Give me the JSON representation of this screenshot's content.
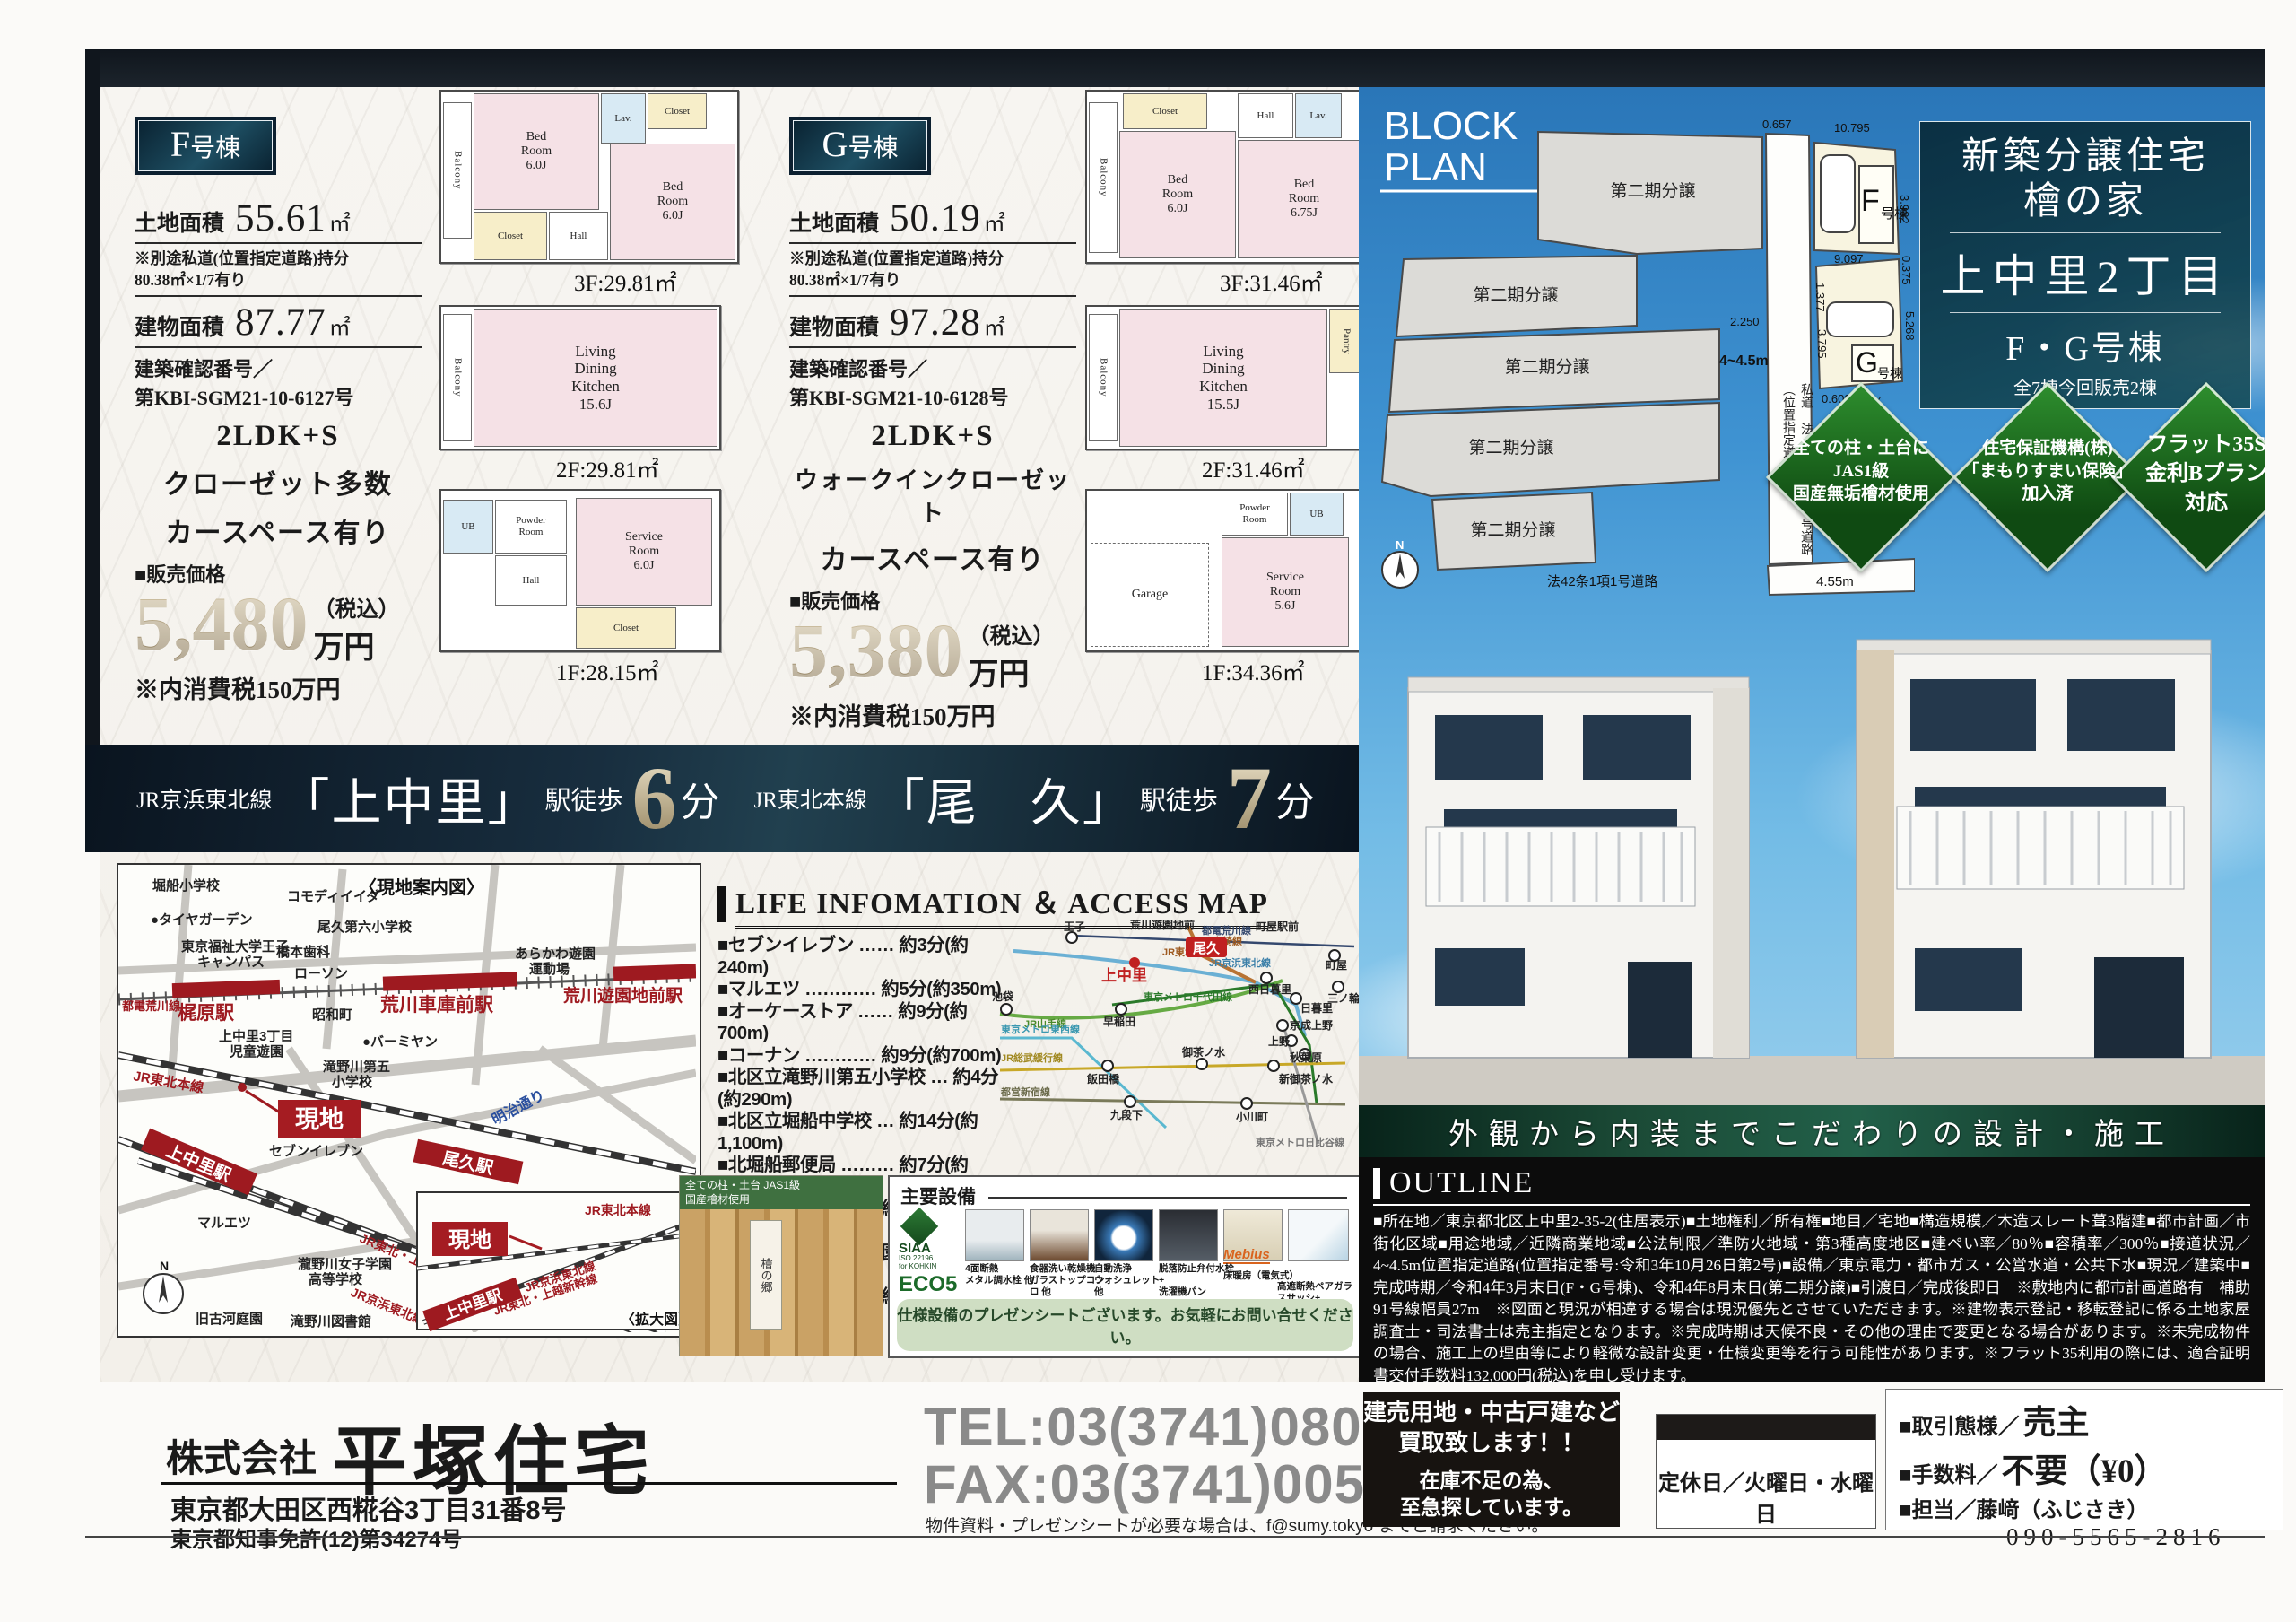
{
  "units": {
    "f": {
      "badge_main": "F",
      "badge_sub": "号棟",
      "land_label": "土地面積",
      "land_value": "55.61",
      "land_unit": "㎡",
      "note": "※別途私道(位置指定道路)持分\n80.38㎡×1/7有り",
      "bldg_label": "建物面積",
      "bldg_value": "87.77",
      "bldg_unit": "㎡",
      "confirm": "建築確認番号／\n第KBI-SGM21-10-6127号",
      "layout": "2LDK+S",
      "feature1": "クローゼット多数",
      "feature2": "カースペース有り",
      "price_label": "■販売価格",
      "price": "5,480",
      "price_tax": "（税込）",
      "price_unit": "万円",
      "price_note": "※内消費税150万円",
      "floors": [
        {
          "area": "3F:29.81㎡",
          "rooms": [
            "Balcony",
            "Bed\nRoom\n6.0J",
            "Lav.",
            "Closet",
            "Bed\nRoom\n6.0J",
            "Closet",
            "Hall"
          ]
        },
        {
          "area": "2F:29.81㎡",
          "rooms": [
            "Balcony",
            "Living\nDining\nKitchen\n15.6J"
          ]
        },
        {
          "area": "1F:28.15㎡",
          "rooms": [
            "UB",
            "Powder\nRoom",
            "Service\nRoom\n6.0J",
            "Hall",
            "Closet"
          ]
        }
      ]
    },
    "g": {
      "badge_main": "G",
      "badge_sub": "号棟",
      "land_label": "土地面積",
      "land_value": "50.19",
      "land_unit": "㎡",
      "note": "※別途私道(位置指定道路)持分\n80.38㎡×1/7有り",
      "bldg_label": "建物面積",
      "bldg_value": "97.28",
      "bldg_unit": "㎡",
      "confirm": "建築確認番号／\n第KBI-SGM21-10-6128号",
      "layout": "2LDK+S",
      "feature1": "ウォークインクローゼット",
      "feature2": "カースペース有り",
      "price_label": "■販売価格",
      "price": "5,380",
      "price_tax": "（税込）",
      "price_unit": "万円",
      "price_note": "※内消費税150万円",
      "floors": [
        {
          "area": "3F:31.46㎡",
          "rooms": [
            "Balcony",
            "Closet",
            "Hall",
            "Lav.",
            "Bed\nRoom\n6.0J",
            "Bed\nRoom\n6.75J"
          ]
        },
        {
          "area": "2F:31.46㎡",
          "rooms": [
            "Balcony",
            "Living\nDining\nKitchen\n15.5J",
            "Pantry"
          ]
        },
        {
          "area": "1F:34.36㎡",
          "rooms": [
            "Garage",
            "Powder\nRoom",
            "UB",
            "Service\nRoom\n5.6J"
          ]
        }
      ]
    }
  },
  "banner": {
    "line1": "JR京浜東北線",
    "station1": "「上中里」",
    "walk1": "駅徒歩",
    "min1": "6",
    "unit1": "分",
    "line2": "JR東北本線",
    "station2": "「尾　久」",
    "walk2": "駅徒歩",
    "min2": "7",
    "unit2": "分"
  },
  "map": {
    "guide": "〈現地案内図〉",
    "genchi": "現地",
    "kakudai": "〈拡大図〉",
    "n": "N",
    "st_kajiwara": "梶原駅",
    "st_shako": "荒川車庫前駅",
    "st_yuenchi": "荒川遊園地前駅",
    "st_kaminakazato": "上中里駅",
    "st_oku": "尾久駅",
    "st_kaminakazato2": "上中里駅",
    "ln_toden": "都電荒川線",
    "ln_tohoku": "JR東北本線",
    "ln_keihin": "JR京浜東北線",
    "ln_shinkansen": "JR東北・上越新幹線",
    "ln_tohoku2": "JR東北本線",
    "ln_keihin2": "JR京浜東北線",
    "ln_shinkansen2": "JR東北・上越新幹線",
    "ln_meiji": "明治通り",
    "poi_horifune": "堀船小学校",
    "poi_tire": "●タイヤガーデン",
    "poi_univ1": "東京福祉大学王子",
    "poi_univ2": "キャンパス",
    "poi_hashimoto": "橋本歯科",
    "poi_lawson": "ローソン",
    "poi_commodi": "コモディイイダ",
    "poi_oku6": "尾久第六小学校",
    "poi_ground1": "あらかわ遊園",
    "poi_ground2": "運動場",
    "poi_showa": "昭和町",
    "poi_jido1": "上中里3丁目",
    "poi_jido2": "児童遊園",
    "poi_taki51": "滝野川第五",
    "poi_taki52": "小学校",
    "poi_bamiyan": "●バーミヤン",
    "poi_seven": "セブンイレブン",
    "poi_maruetsu": "マルエツ",
    "poi_joshi1": "瀧野川女子学園",
    "poi_joshi2": "高等学校",
    "poi_lib": "滝野川図書館",
    "poi_garden": "旧古河庭園"
  },
  "access": {
    "title": "LIFE INFOMATION ＆ ACCESS MAP",
    "items": [
      "■セブンイレブン …… 約3分(約240m)",
      "■マルエツ ………… 約5分(約350m)",
      "■オーケーストア …… 約9分(約700m)",
      "■コーナン ………… 約9分(約700m)",
      "■北区立滝野川第五小学校 … 約4分(約290m)",
      "■北区立堀船中学校 … 約14分(約1,100m)",
      "■北堀船郵便局 ……… 約7分(約550m)",
      "■滝野川図書館 …… 約10分(約750m)",
      "■上中里3丁目児童遊園 … 約3分(約190m)",
      "■旧古河庭園 ……… 約10分(約800m)"
    ]
  },
  "railmap": {
    "oji": "王子",
    "kaminakazato": "上中里",
    "oku": "尾久",
    "yuenchimae": "荒川遊園地前",
    "machiyaekimae": "町屋駅前",
    "machiya": "町屋",
    "minowa": "三ノ輪",
    "nishinippori": "西日暮里",
    "nippori": "日暮里",
    "ikebukuro": "池袋",
    "waseda": "早稲田",
    "keiseiueno": "京成上野",
    "ueno": "上野",
    "akihabara": "秋葉原",
    "ochanomizu": "御茶ノ水",
    "shinochanomizu": "新御茶ノ水",
    "iidabashi": "飯田橋",
    "kudanshita": "九段下",
    "ogawamachi": "小川町",
    "ln_toden": "都電荒川線",
    "ln_keihin": "JR京浜東北線",
    "ln_takasaki": "高崎線",
    "ln_yamanote": "JR山手線",
    "ln_chiyoda": "東京メトロ千代田線",
    "ln_tozai": "東京メトロ東西線",
    "ln_sobu": "JR総武緩行線",
    "ln_shinjuku": "都営新宿線",
    "ln_hibiya": "東京メトロ日比谷線",
    "ln_tohoku": "JR東北本線"
  },
  "equipment": {
    "title": "主要設備",
    "siaa1": "SIAA",
    "siaa2": "ISO 22196",
    "siaa3": "for KOHKIN",
    "eco": "ECO5",
    "mebius": "Mebius",
    "captions": [
      "4面断熱\nメタル調水栓 他",
      "食器洗い乾燥機\nガラストップコンロ 他",
      "自動洗浄\nウォシュレット 他",
      "脱落防止弁付水栓+\n洗濯機パン",
      "床暖房（電気式）",
      "高遮断熱ペアガラスサッシ+\n高性能グラスウール"
    ],
    "banner": "仕様設備のプレゼンシートございます。お気軽にお問い合せください。"
  },
  "hinoki": {
    "strip": "全ての柱・土台 JAS1級\n国産檜材使用",
    "tag": "檜の郷"
  },
  "blockplan": {
    "title1": "BLOCK",
    "title2": "PLAN",
    "n": "N",
    "parcel1": "第二期分譲",
    "parcel2": "第二期分譲",
    "parcel3": "第二期分譲",
    "parcel4": "第二期分譲",
    "parcel5": "第二期分譲",
    "f_main": "F",
    "f_sub": "号棟",
    "g_main": "G",
    "g_sub": "号棟",
    "shido": "私道 法42条1項5号道路（位置指定道路）",
    "width": "4~4.5m",
    "road_b": "法42条1項1号道路",
    "road_b_w": "4.55m",
    "dims": [
      "0.657",
      "10.795",
      "3.982",
      "0.375",
      "9.097",
      "2.250",
      "1.377",
      "3.795",
      "5.268",
      "0.600",
      "9.077"
    ]
  },
  "title_box": {
    "l1": "新築分譲住宅",
    "l2": "檜の家",
    "l3": "上中里2丁目",
    "l4": "F・G号棟",
    "l5": "全7棟今回販売2棟"
  },
  "diamonds": [
    {
      "l1": "全ての柱・土台に",
      "l2": "JAS1級",
      "l3": "国産無垢檜材使用"
    },
    {
      "l1": "住宅保証機構(株)",
      "l2": "「まもりすまい保険」",
      "l3": "加入済"
    },
    {
      "l1": "フラット35S",
      "l2": "金利Bプラン",
      "l3": "対応"
    }
  ],
  "photo_caption": "外観から内装までこだわりの設計・施工",
  "outline": {
    "title": "OUTLINE",
    "text": "■所在地／東京都北区上中里2-35-2(住居表示)■土地権利／所有権■地目／宅地■構造規模／木造スレート葺3階建■都市計画／市街化区域■用途地域／近隣商業地域■公法制限／準防火地域・第3種高度地区■建ぺい率／80％■容積率／300％■接道状況／4~4.5m位置指定道路(位置指定番号:令和3年10月26日第2号)■設備／東京電力・都市ガス・公営水道・公共下水■現況／建築中■完成時期／令和4年3月末日(F・G号棟)、令和4年8月末日(第二期分譲)■引渡日／完成後即日　※敷地内に都市計画道路有　補助91号線幅員27m　※図面と現況が相違する場合は現況優先とさせていただきます。※建物表示登記・移転登記に係る土地家屋調査士・司法書士は売主指定となります。※完成時期は天候不良・その他の理由で変更となる場合があります。※未完成物件の場合、施工上の理由等により軽微な設計変更・仕様変更等を行う可能性があります。※フラット35利用の際には、適合証明書交付手数料132,000円(税込)を申し受けます。"
  },
  "footer": {
    "company_prefix": "株式会社",
    "company_name": "平塚住宅",
    "tel": "TEL:03(3741)0800",
    "fax": "FAX:03(3741)0050",
    "mailnote": "物件資料・プレゼンシートが必要な場合は、f@sumy.tokyo までご請求ください。",
    "address": "東京都大田区西糀谷3丁目31番8号",
    "license": "東京都知事免許(12)第34274号",
    "buy1": "建売用地・中古戸建など\n買取致します！！",
    "buy2": "在庫不足の為、\n至急探しています。",
    "holiday": "定休日／火曜日・水曜日",
    "deal_label": "■取引態様／",
    "deal_value": "売主",
    "fee_label": "■手数料／",
    "fee_value": "不要（¥0）",
    "contact_label": "■担当／",
    "contact_value": "藤﨑（ふじさき）",
    "phone": "090-5565-2816"
  }
}
